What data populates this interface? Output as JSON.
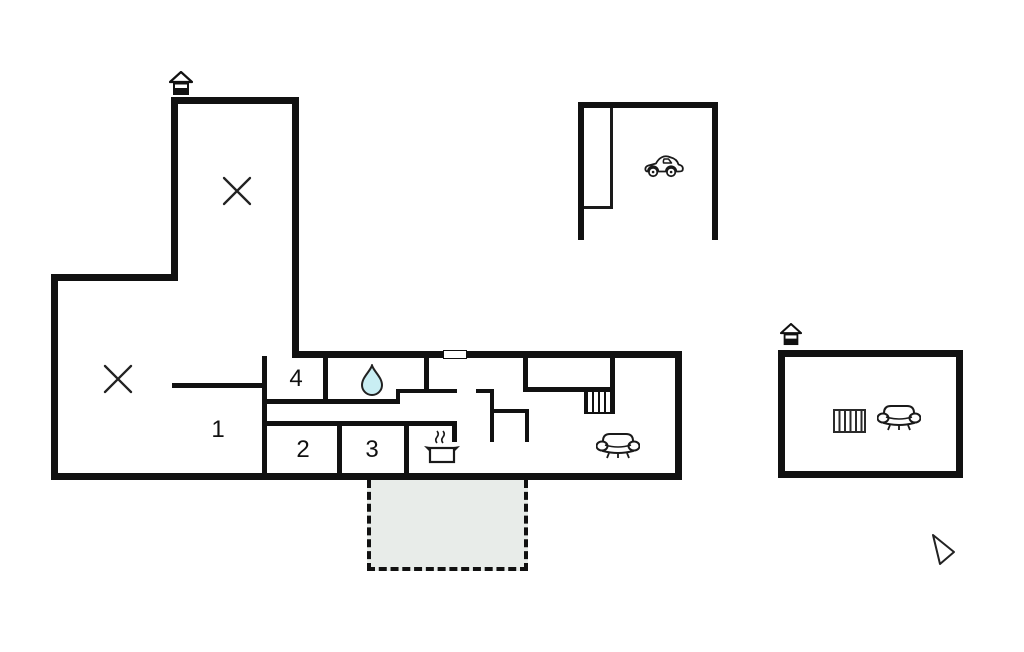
{
  "title": "Holiday home floor plan",
  "floorplan": {
    "rooms": [
      {
        "id": "room-1",
        "label": "1"
      },
      {
        "id": "room-2",
        "label": "2"
      },
      {
        "id": "room-3",
        "label": "3"
      },
      {
        "id": "room-4",
        "label": "4"
      }
    ],
    "areas": {
      "bathroom_marker": "water-drop",
      "kitchen_marker": "cooking-pot-with-steam",
      "living_room_marker": "sofa",
      "garage_marker": "car",
      "annex_markers": [
        "stairs-hatch",
        "sofa"
      ],
      "main_house_markers": [
        "stairs-hatch",
        "entrance-house-symbol",
        "x-marker",
        "x-marker"
      ],
      "annex_entrance_marker": "entrance-house-symbol",
      "wall_opening_marker": "window",
      "terrace": "dashed-outline-area",
      "pointer": "mouse-cursor-arrow"
    },
    "colors": {
      "wall": "#111111",
      "icon_stroke": "#1a1a1a",
      "water_drop_fill": "#c9eef3",
      "terrace_fill": "#e8ece9",
      "background": "#ffffff"
    }
  }
}
